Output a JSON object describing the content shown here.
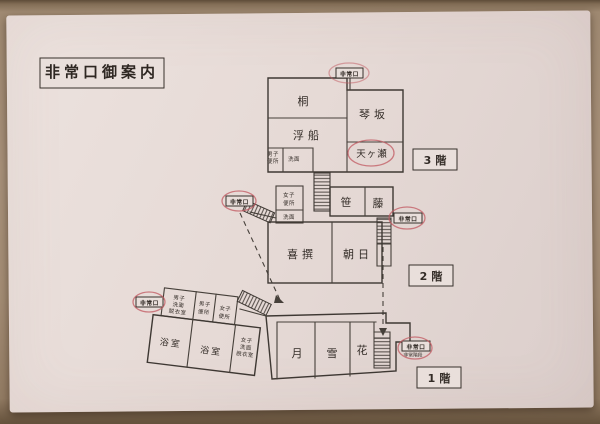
{
  "title": "非常口御案内",
  "exit_label": "非常口",
  "colors": {
    "ink": "#3e3833",
    "red_mark": "#c25a62",
    "paper": "#e6dad6",
    "wood": "#a8917a"
  },
  "floors": {
    "f3": {
      "badge": "3階",
      "rooms": {
        "kiri": "桐",
        "ukifune": "浮船",
        "kotosaka": "琴坂",
        "amagase": "天ヶ瀬"
      },
      "toilet": [
        "男子",
        "便所"
      ],
      "wash": "洗面"
    },
    "f2": {
      "badge": "2階",
      "rooms": {
        "sasa": "笹",
        "fuji": "藤",
        "kisen": "喜撰",
        "asahi": "朝日"
      },
      "toilet": [
        "女子",
        "便所"
      ],
      "wash": "洗面"
    },
    "f1": {
      "badge": "1階",
      "rooms": {
        "tsuki": "月",
        "yuki": "雪",
        "hana": "花",
        "bath1": "浴室",
        "bath2": "浴室"
      },
      "mens_change": [
        "男子",
        "洗面",
        "脱衣室"
      ],
      "mens_toilet": [
        "男子",
        "便所"
      ],
      "womens_toilet": [
        "女子",
        "便所"
      ],
      "womens_change": [
        "女子",
        "洗面",
        "脱衣室"
      ],
      "exit_sub": "非常階段"
    }
  }
}
